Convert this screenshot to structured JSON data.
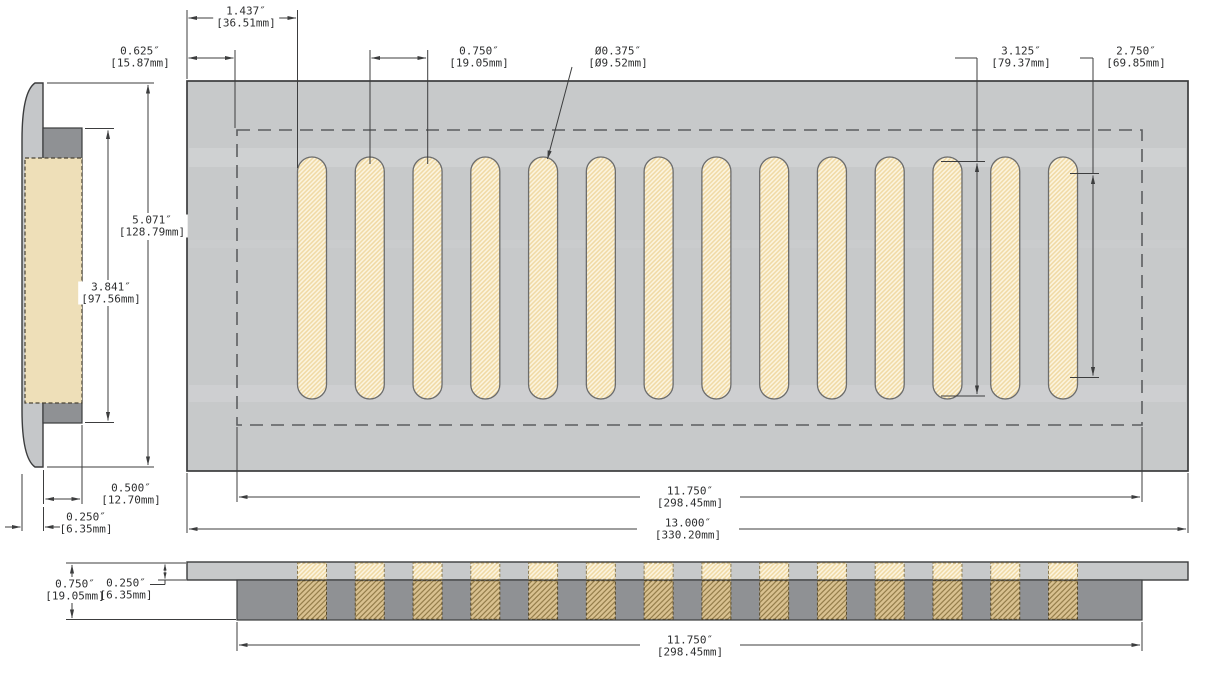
{
  "dims": {
    "d1437": {
      "in": "1.437″",
      "mm": "[36.51mm]"
    },
    "d0625": {
      "in": "0.625″",
      "mm": "[15.87mm]"
    },
    "d0750_top": {
      "in": "0.750″",
      "mm": "[19.05mm]"
    },
    "d0375": {
      "in": "Ø0.375″",
      "mm": "[Ø9.52mm]"
    },
    "d3125": {
      "in": "3.125″",
      "mm": "[79.37mm]"
    },
    "d2750": {
      "in": "2.750″",
      "mm": "[69.85mm]"
    },
    "d5071": {
      "in": "5.071″",
      "mm": "[128.79mm]"
    },
    "d3841": {
      "in": "3.841″",
      "mm": "[97.56mm]"
    },
    "d0500": {
      "in": "0.500″",
      "mm": "[12.70mm]"
    },
    "d0250_side": {
      "in": "0.250″",
      "mm": "[6.35mm]"
    },
    "d11750_main": {
      "in": "11.750″",
      "mm": "[298.45mm]"
    },
    "d13000": {
      "in": "13.000″",
      "mm": "[330.20mm]"
    },
    "d0750_front": {
      "in": "0.750″",
      "mm": "[19.05mm]"
    },
    "d0250_front": {
      "in": "0.250″",
      "mm": "[6.35mm]"
    },
    "d11750_front": {
      "in": "11.750″",
      "mm": "[298.45mm]"
    }
  },
  "slots": {
    "count": 14
  },
  "colors": {
    "plate_gray": "#c7c9ca",
    "dark_gray": "#8f9194",
    "flange_gray": "#c5c7c9",
    "slot_cream": "#fcf5e0",
    "slot_hatch": "#f0d9a4",
    "side_tan_plain": "#eedfb8",
    "side_tan_hatch_bg": "#e5d2a4",
    "side_tan_hatch_line": "#a78c55",
    "front_seg_bg": "#d9c190",
    "front_seg_line": "#8f7845",
    "line_ink": "#3c3d3e",
    "text_ink": "#2e2f30"
  }
}
